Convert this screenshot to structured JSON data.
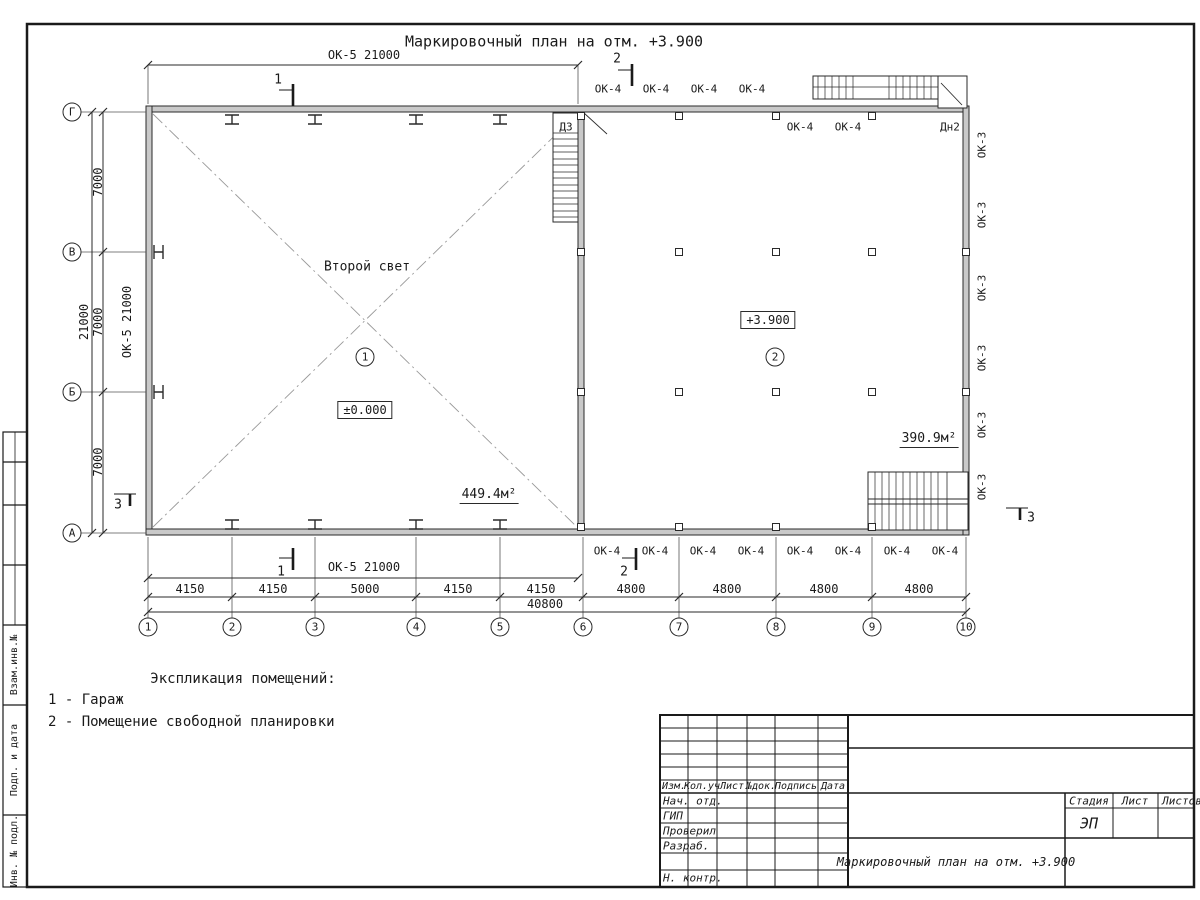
{
  "sheet_title": "Маркировочный план на отм. +3.900",
  "plan": {
    "second_light": "Второй свет",
    "room1_number": "1",
    "room1_level": "±0.000",
    "room1_area": "449.4м²",
    "room1_door": "ДЗ",
    "room2_number": "2",
    "room2_level": "+3.900",
    "room2_area": "390.9м²",
    "room2_door": "Дн2"
  },
  "windows": {
    "ok5": "ОК-5 21000",
    "ok4": "ОК-4",
    "ok3": "ОК-3"
  },
  "axes": {
    "cols": [
      "1",
      "2",
      "3",
      "4",
      "5",
      "6",
      "7",
      "8",
      "9",
      "10"
    ],
    "rows": [
      "Г",
      "В",
      "Б",
      "А"
    ]
  },
  "dims": {
    "left": [
      "7000",
      "7000",
      "7000"
    ],
    "left_total": "21000",
    "bottom": [
      "4150",
      "4150",
      "5000",
      "4150",
      "4150",
      "4800",
      "4800",
      "4800",
      "4800"
    ],
    "bottom_total": "40800"
  },
  "sections": {
    "s1": "1",
    "s2": "2",
    "s3": "3"
  },
  "explication": {
    "heading": "Экспликация помещений:",
    "item1": "1 - Гараж",
    "item2": "2 - Помещение свободной планировки"
  },
  "titleblock": {
    "col_izm": "Изм.",
    "col_koluch": "Кол.уч",
    "col_list": "Лист",
    "col_ndok": "№док.",
    "col_podpis": "Подпись",
    "col_data": "Дата",
    "row_nachotd": "Нач. отд.",
    "row_gip": "ГИП",
    "row_proveril": "Проверил",
    "row_razrab": "Разраб.",
    "row_nkontr": "Н. контр.",
    "stage_label": "Стадия",
    "sheet_label": "Лист",
    "sheets_label": "Листов",
    "stage_value": "ЭП",
    "doc_title": "Маркировочный план на отм. +3.900"
  },
  "margin": {
    "l1": "Взам.инв.№",
    "l2": "Подп. и дата",
    "l3": "Инв. № подл."
  }
}
